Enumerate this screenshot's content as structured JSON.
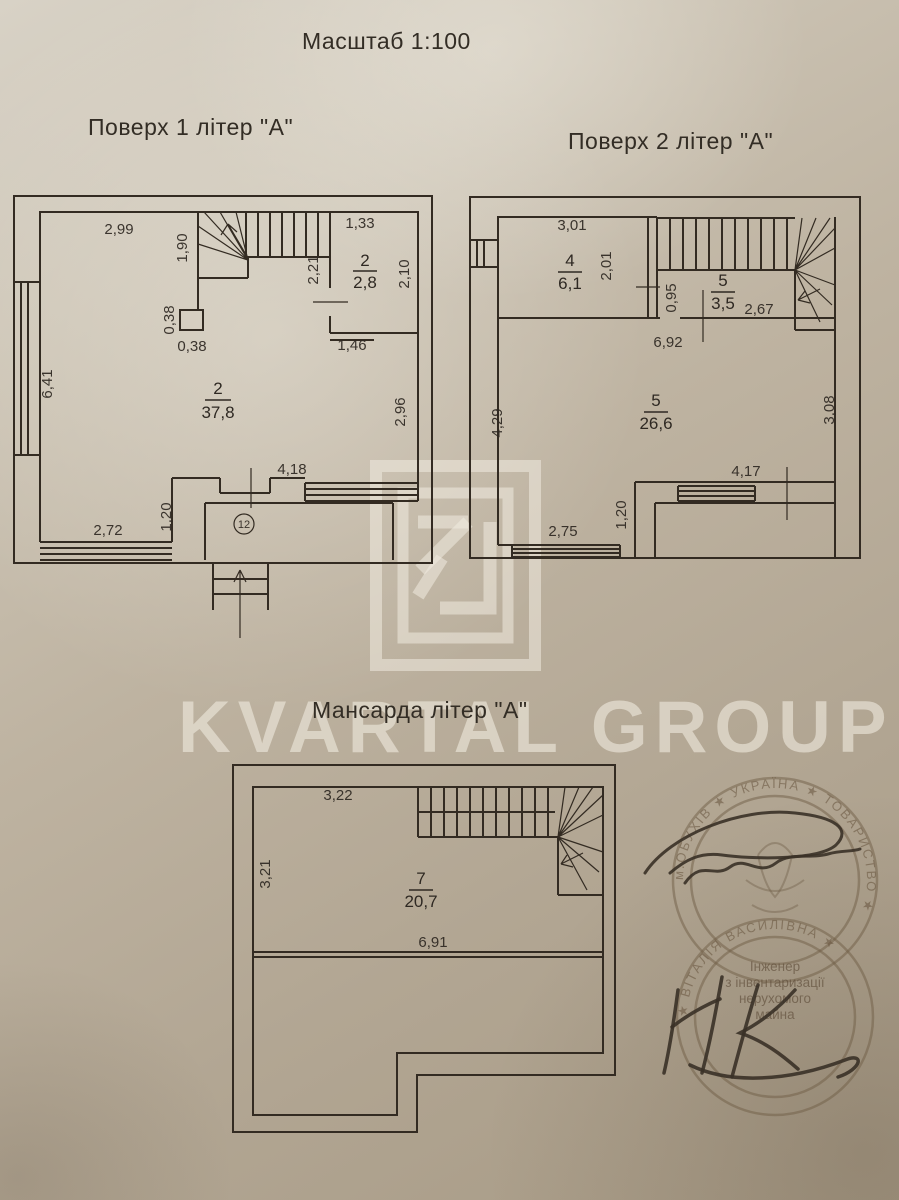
{
  "page": {
    "scale_label": "Масштаб 1:100"
  },
  "watermark": {
    "brand": "KVARTAL GROUP",
    "logo_monogram": "KG"
  },
  "floor1": {
    "title": "Поверх 1 літер \"А\"",
    "room_hall": {
      "number": "2",
      "area": "2,8"
    },
    "room_main": {
      "number": "2",
      "area": "37,8"
    },
    "porch_number": "12",
    "dims": {
      "top_wall": "2,99",
      "stair_depth": "1,90",
      "hall_top": "1,33",
      "hall_left": "2,21",
      "hall_right": "2,10",
      "nib_height": "0,38",
      "nib_width": "0,38",
      "hall_bottom": "1,46",
      "left_wall": "6,41",
      "right_wall": "2,96",
      "window_right": "4,18",
      "porch_step": "1,20",
      "window_left": "2,72"
    }
  },
  "floor2": {
    "title": "Поверх 2 літер \"А\"",
    "room4": {
      "number": "4",
      "area": "6,1"
    },
    "room5_hall": {
      "number": "5",
      "area": "3,5"
    },
    "room5_main": {
      "number": "5",
      "area": "26,6"
    },
    "dims": {
      "top_wall": "3,01",
      "room4_side": "2,01",
      "hall_side": "0,95",
      "stair_run": "2,67",
      "inner_width": "6,92",
      "left_wall": "4,29",
      "right_wall": "3,08",
      "window_right": "4,17",
      "terrace_step": "1,20",
      "window_left": "2,75"
    }
  },
  "mansard": {
    "title": "Мансарда літер \"А\"",
    "room7": {
      "number": "7",
      "area": "20,7"
    },
    "dims": {
      "top_wall": "3,22",
      "left_wall": "3,21",
      "inner_width": "6,91"
    }
  },
  "stamps": {
    "seal_top": {
      "ring_text": "м.ОБУХІВ  ★  УКРАЇНА  ★  ТОВАРИСТВО  ★"
    },
    "seal_bottom": {
      "center_lines": [
        "Інженер",
        "з інвентаризації",
        "нерухомого",
        "майна"
      ],
      "ring_text": "★  ВІТАЛІЯ ВАСИЛІВНА  ★"
    }
  }
}
